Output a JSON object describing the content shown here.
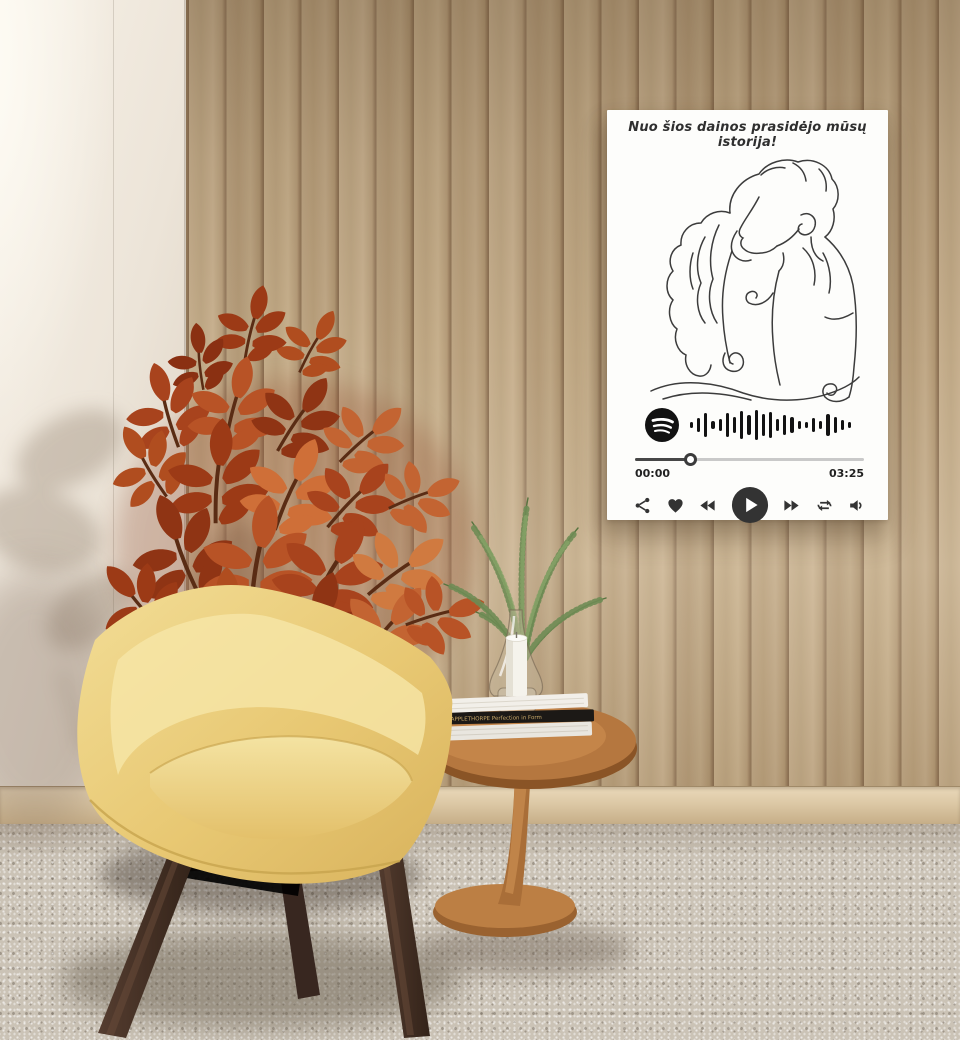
{
  "scene": {
    "description": "Living-room product mockup: personalised song poster on a wooden slat wall, yellow armchair, rust-coloured plant and oak side table",
    "colors": {
      "wood_wall": "#bda27e",
      "white_wall": "#efe7da",
      "baseboard": "#dcc8a5",
      "carpet": "#cbc3b6",
      "chair_fabric": "#e8c873",
      "chair_legs": "#46332a",
      "plant_foliage": "#a8431d",
      "table_wood": "#b5773f",
      "poster_background": "#fdfdfb",
      "poster_ink": "#333333"
    }
  },
  "poster": {
    "title": "Nuo šios dainos prasidėjo mūsų istorija!",
    "artwork": "one-line drawing of a kissing couple",
    "spotify_logo": "spotify-logo",
    "code_bars": [
      6,
      14,
      24,
      8,
      12,
      24,
      16,
      28,
      20,
      30,
      22,
      26,
      12,
      20,
      16,
      8,
      6,
      14,
      8,
      22,
      16,
      10,
      6
    ],
    "player": {
      "elapsed": "00:00",
      "duration": "03:25",
      "progress_percent": 24,
      "controls": [
        "share-icon",
        "heart-icon",
        "previous-icon",
        "play-icon",
        "next-icon",
        "repeat-icon",
        "volume-icon"
      ]
    }
  },
  "side_table": {
    "book_spine": "MAPPLETHORPE Perfection in Form"
  }
}
